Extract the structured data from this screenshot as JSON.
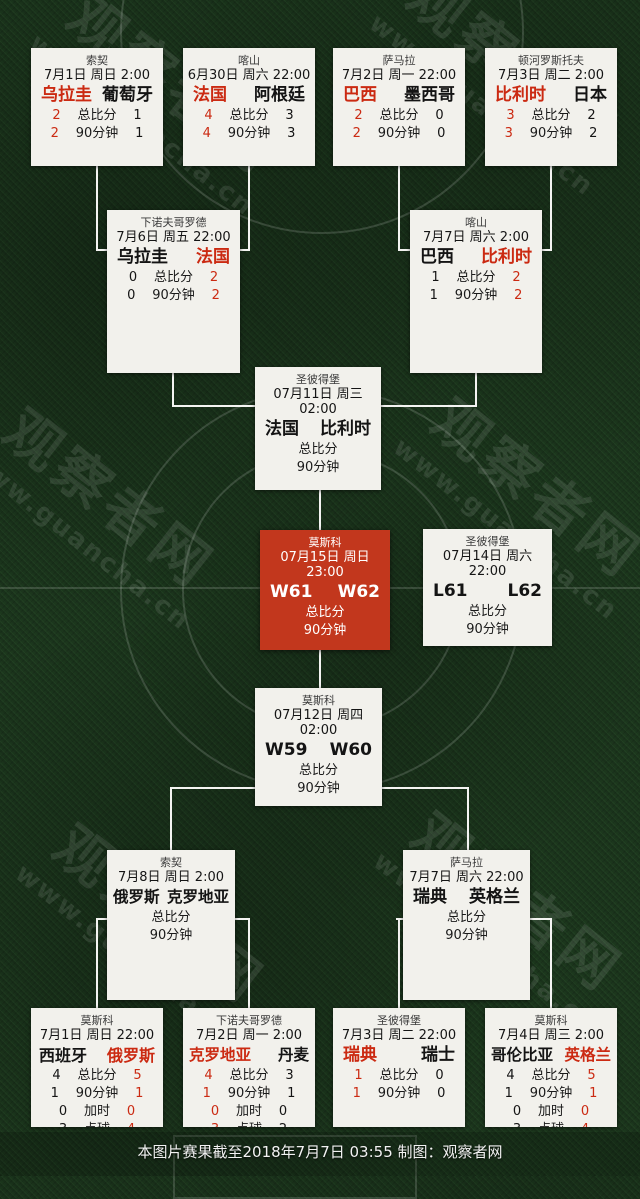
{
  "site": {
    "watermark_name": "观察者网",
    "watermark_url": "www.guancha.cn"
  },
  "footer": {
    "note": "本图片赛果截至2018年7月7日 03:55 制图：观察者网"
  },
  "colors": {
    "grass": "#1e3a1f",
    "card_bg": "#f2f1ec",
    "accent_red": "#cb2a12",
    "final_card_red": "#c2371d",
    "connector_line": "#f4f4f2"
  },
  "stat_labels": {
    "total": "总比分",
    "ninety": "90分钟",
    "extra": "加时",
    "pens": "点球"
  },
  "matches": [
    {
      "id": "r16-1",
      "venue": "索契",
      "datetime": "7月1日 周日 2:00",
      "home": "乌拉圭",
      "away": "葡萄牙",
      "home_clr": "red",
      "away_clr": "black",
      "rows": [
        {
          "label": "总比分",
          "h": "2",
          "a": "1"
        },
        {
          "label": "90分钟",
          "h": "2",
          "a": "1"
        }
      ]
    },
    {
      "id": "r16-2",
      "venue": "喀山",
      "datetime": "6月30日 周六 22:00",
      "home": "法国",
      "away": "阿根廷",
      "home_clr": "red",
      "away_clr": "black",
      "rows": [
        {
          "label": "总比分",
          "h": "4",
          "a": "3"
        },
        {
          "label": "90分钟",
          "h": "4",
          "a": "3"
        }
      ]
    },
    {
      "id": "r16-3",
      "venue": "萨马拉",
      "datetime": "7月2日 周一 22:00",
      "home": "巴西",
      "away": "墨西哥",
      "home_clr": "red",
      "away_clr": "black",
      "rows": [
        {
          "label": "总比分",
          "h": "2",
          "a": "0"
        },
        {
          "label": "90分钟",
          "h": "2",
          "a": "0"
        }
      ]
    },
    {
      "id": "r16-4",
      "venue": "顿河罗斯托夫",
      "datetime": "7月3日 周二 2:00",
      "home": "比利时",
      "away": "日本",
      "home_clr": "red",
      "away_clr": "black",
      "rows": [
        {
          "label": "总比分",
          "h": "3",
          "a": "2"
        },
        {
          "label": "90分钟",
          "h": "3",
          "a": "2"
        }
      ]
    },
    {
      "id": "qf-1",
      "venue": "下诺夫哥罗德",
      "datetime": "7月6日 周五 22:00",
      "home": "乌拉圭",
      "away": "法国",
      "home_clr": "black",
      "away_clr": "red",
      "rows": [
        {
          "label": "总比分",
          "h": "0",
          "a": "2"
        },
        {
          "label": "90分钟",
          "h": "0",
          "a": "2"
        }
      ]
    },
    {
      "id": "qf-2",
      "venue": "喀山",
      "datetime": "7月7日 周六 2:00",
      "home": "巴西",
      "away": "比利时",
      "home_clr": "black",
      "away_clr": "red",
      "rows": [
        {
          "label": "总比分",
          "h": "1",
          "a": "2"
        },
        {
          "label": "90分钟",
          "h": "1",
          "a": "2"
        }
      ]
    },
    {
      "id": "sf-1",
      "venue": "圣彼得堡",
      "datetime": "07月11日 周三 02:00",
      "home": "法国",
      "away": "比利时",
      "home_clr": "black",
      "away_clr": "black",
      "rows": [
        {
          "label": "总比分",
          "h": "",
          "a": ""
        },
        {
          "label": "90分钟",
          "h": "",
          "a": ""
        }
      ]
    },
    {
      "id": "final",
      "venue": "莫斯科",
      "datetime": "07月15日 周日 23:00",
      "home": "W61",
      "away": "W62",
      "home_clr": "white",
      "away_clr": "white",
      "rows": [
        {
          "label": "总比分",
          "h": "",
          "a": ""
        },
        {
          "label": "90分钟",
          "h": "",
          "a": ""
        }
      ]
    },
    {
      "id": "third-place",
      "venue": "圣彼得堡",
      "datetime": "07月14日 周六 22:00",
      "home": "L61",
      "away": "L62",
      "home_clr": "black",
      "away_clr": "black",
      "rows": [
        {
          "label": "总比分",
          "h": "",
          "a": ""
        },
        {
          "label": "90分钟",
          "h": "",
          "a": ""
        }
      ]
    },
    {
      "id": "sf-2",
      "venue": "莫斯科",
      "datetime": "07月12日 周四 02:00",
      "home": "W59",
      "away": "W60",
      "home_clr": "black",
      "away_clr": "black",
      "rows": [
        {
          "label": "总比分",
          "h": "",
          "a": ""
        },
        {
          "label": "90分钟",
          "h": "",
          "a": ""
        }
      ]
    },
    {
      "id": "qf-3",
      "venue": "索契",
      "datetime": "7月8日 周日 2:00",
      "home": "俄罗斯",
      "away": "克罗地亚",
      "home_clr": "black",
      "away_clr": "black",
      "rows": [
        {
          "label": "总比分",
          "h": "",
          "a": ""
        },
        {
          "label": "90分钟",
          "h": "",
          "a": ""
        }
      ]
    },
    {
      "id": "qf-4",
      "venue": "萨马拉",
      "datetime": "7月7日 周六 22:00",
      "home": "瑞典",
      "away": "英格兰",
      "home_clr": "black",
      "away_clr": "black",
      "rows": [
        {
          "label": "总比分",
          "h": "",
          "a": ""
        },
        {
          "label": "90分钟",
          "h": "",
          "a": ""
        }
      ]
    },
    {
      "id": "r16-5",
      "venue": "莫斯科",
      "datetime": "7月1日 周日 22:00",
      "home": "西班牙",
      "away": "俄罗斯",
      "home_clr": "black",
      "away_clr": "red",
      "rows": [
        {
          "label": "总比分",
          "h": "4",
          "a": "5"
        },
        {
          "label": "90分钟",
          "h": "1",
          "a": "1"
        },
        {
          "label": "加时",
          "h": "0",
          "a": "0"
        },
        {
          "label": "点球",
          "h": "3",
          "a": "4"
        }
      ]
    },
    {
      "id": "r16-6",
      "venue": "下诺夫哥罗德",
      "datetime": "7月2日 周一 2:00",
      "home": "克罗地亚",
      "away": "丹麦",
      "home_clr": "red",
      "away_clr": "black",
      "rows": [
        {
          "label": "总比分",
          "h": "4",
          "a": "3"
        },
        {
          "label": "90分钟",
          "h": "1",
          "a": "1"
        },
        {
          "label": "加时",
          "h": "0",
          "a": "0"
        },
        {
          "label": "点球",
          "h": "3",
          "a": "2"
        }
      ]
    },
    {
      "id": "r16-7",
      "venue": "圣彼得堡",
      "datetime": "7月3日 周二 22:00",
      "home": "瑞典",
      "away": "瑞士",
      "home_clr": "red",
      "away_clr": "black",
      "rows": [
        {
          "label": "总比分",
          "h": "1",
          "a": "0"
        },
        {
          "label": "90分钟",
          "h": "1",
          "a": "0"
        }
      ]
    },
    {
      "id": "r16-8",
      "venue": "莫斯科",
      "datetime": "7月4日 周三 2:00",
      "home": "哥伦比亚",
      "away": "英格兰",
      "home_clr": "black",
      "away_clr": "red",
      "rows": [
        {
          "label": "总比分",
          "h": "4",
          "a": "5"
        },
        {
          "label": "90分钟",
          "h": "1",
          "a": "1"
        },
        {
          "label": "加时",
          "h": "0",
          "a": "0"
        },
        {
          "label": "点球",
          "h": "3",
          "a": "4"
        }
      ]
    }
  ]
}
